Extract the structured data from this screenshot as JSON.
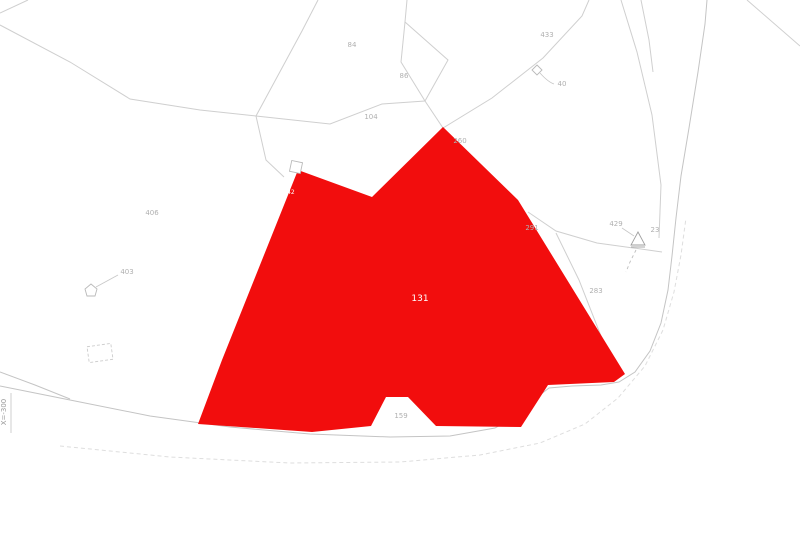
{
  "map": {
    "colors": {
      "background": "#ffffff",
      "highlight": "#f20d0d",
      "boundary_line": "#cfcfcf",
      "label_text": "#b0b0b0",
      "highlight_label_text": "#ffffff"
    },
    "axis_label": "X=-300",
    "main_parcel": {
      "number": "131",
      "sub_number": "142"
    },
    "parcel_labels": [
      {
        "text": "84",
        "x": 352,
        "y": 47
      },
      {
        "text": "86",
        "x": 404,
        "y": 78
      },
      {
        "text": "104",
        "x": 371,
        "y": 119
      },
      {
        "text": "433",
        "x": 547,
        "y": 37
      },
      {
        "text": "40",
        "x": 562,
        "y": 86
      },
      {
        "text": "260",
        "x": 460,
        "y": 143
      },
      {
        "text": "406",
        "x": 152,
        "y": 215
      },
      {
        "text": "403",
        "x": 127,
        "y": 274
      },
      {
        "text": "291",
        "x": 532,
        "y": 230
      },
      {
        "text": "429",
        "x": 616,
        "y": 226
      },
      {
        "text": "23",
        "x": 655,
        "y": 232
      },
      {
        "text": "283",
        "x": 596,
        "y": 293
      },
      {
        "text": "159",
        "x": 401,
        "y": 418
      }
    ],
    "icons": [
      {
        "name": "building-icon"
      },
      {
        "name": "diamond-marker-icon"
      },
      {
        "name": "house-marker-icon"
      },
      {
        "name": "triangle-marker-icon"
      },
      {
        "name": "dashed-plot-outline"
      }
    ]
  }
}
